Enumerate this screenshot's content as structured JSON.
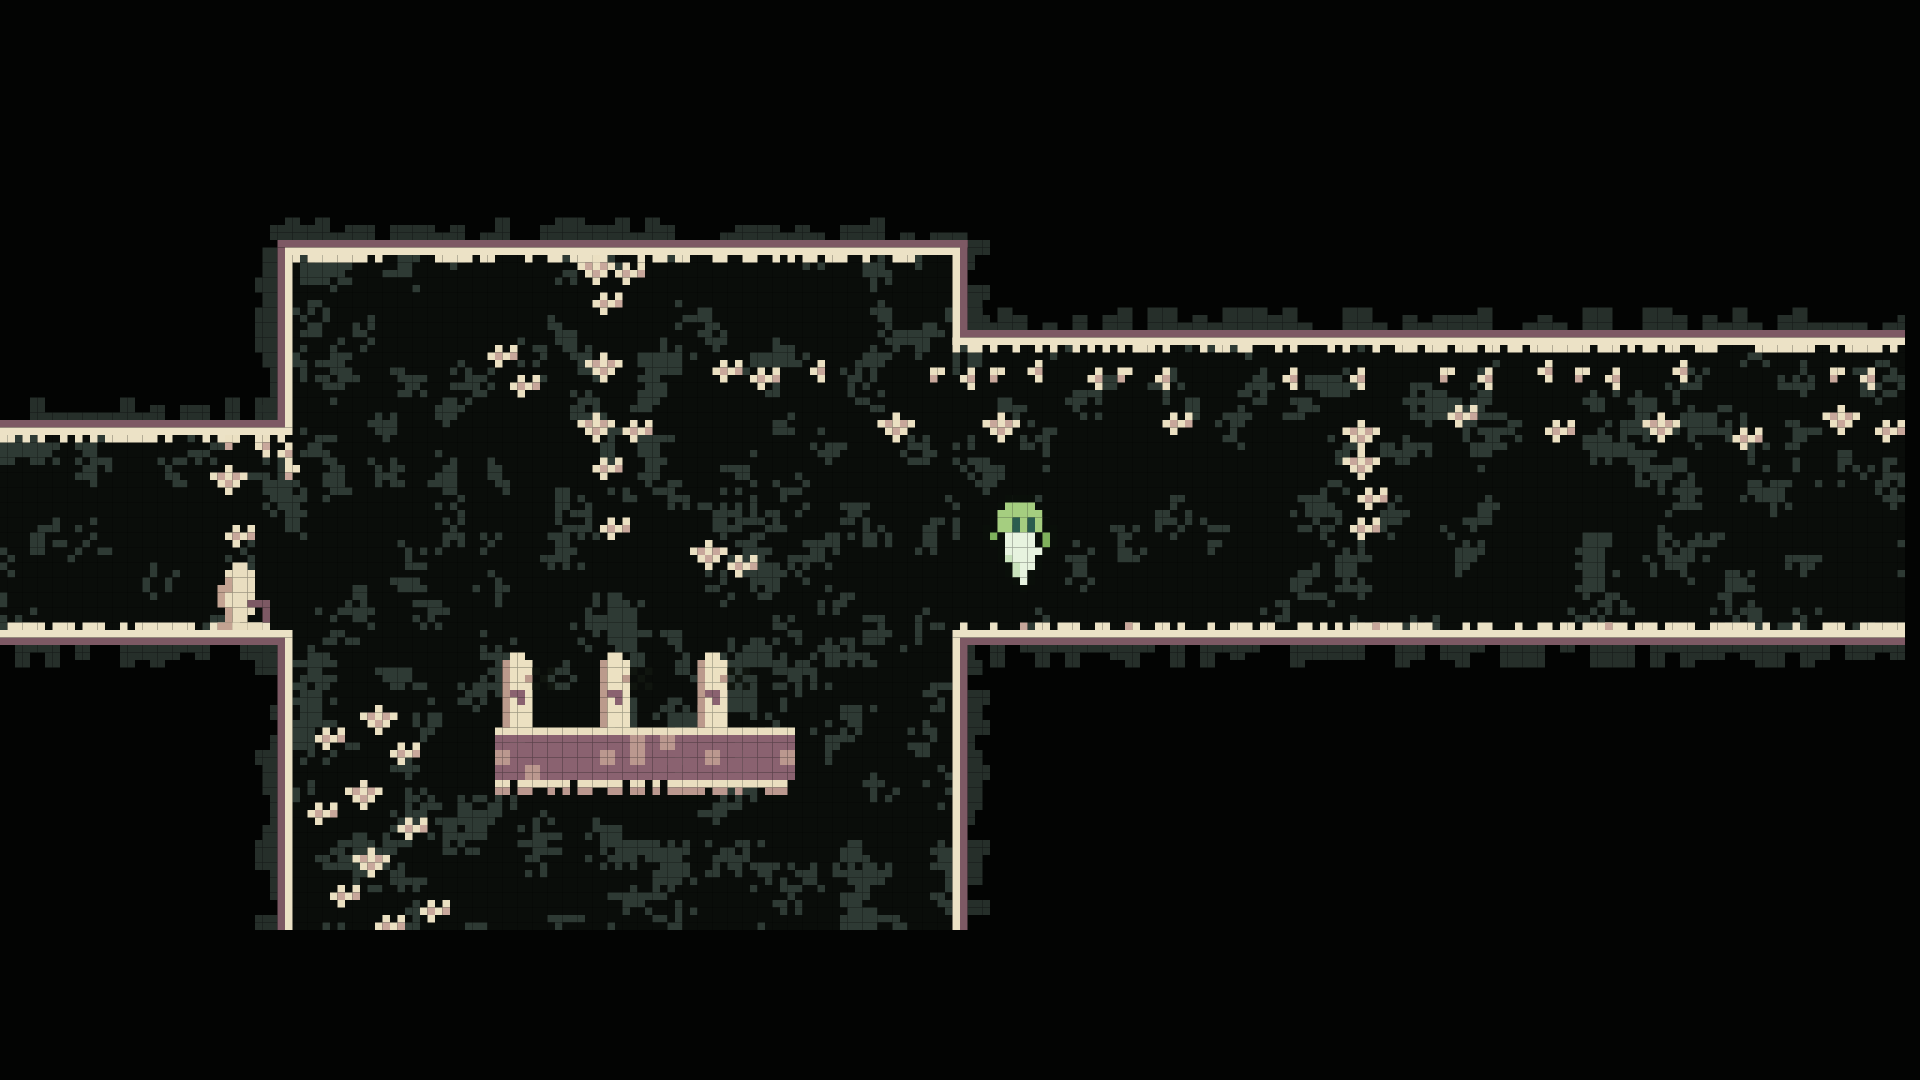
{
  "meta": {
    "scene": "pixel-art cave platformer room with floating ghost player"
  },
  "viewport": {
    "width": 1920,
    "height": 1080,
    "pixel_size": 7.5,
    "grid_w": 256,
    "grid_h": 144,
    "background": "#000000"
  },
  "palette": {
    "void": "#030403",
    "camo_green": "#5c7157",
    "camo_slate": "#2e3a34",
    "camo_black": "#0a0d0a",
    "fringe_green": "#44524a",
    "fringe_slate": "#262f2a",
    "border_cream": "#ece2c6",
    "border_mauve": "#7d5964",
    "plant_cream": "#ebe0c2",
    "plant_tan": "#c8a79b",
    "platform_cream": "#eadfc0",
    "platform_mauve": "#8a6270",
    "platform_tan": "#bb988f",
    "pillar_cream": "#ece1c2",
    "pillar_tan": "#bb9a8c",
    "pillar_mauve": "#8a6270",
    "decal_dark": "#10150f",
    "statue_cream": "#e9dec0",
    "statue_tan": "#c3a392",
    "statue_mauve": "#7d5964",
    "player_light": "#a5ce80",
    "player_green": "#7fb15c",
    "player_eye": "#2b5d4f",
    "player_body": "#e7f3df",
    "player_shade": "#c9e2bc",
    "player_outline": "#0a0f0a"
  },
  "regions": [
    {
      "name": "main-room",
      "x": 39,
      "y": 34,
      "w": 88,
      "h": 90
    },
    {
      "name": "left-corridor",
      "x": 0,
      "y": 58,
      "w": 39,
      "h": 26
    },
    {
      "name": "right-corridor",
      "x": 127,
      "y": 46,
      "w": 127,
      "h": 38
    }
  ],
  "borders": {
    "mauve": [
      {
        "x": 37,
        "y": 32,
        "w": 92,
        "h": 1
      },
      {
        "x": 37,
        "y": 33,
        "w": 1,
        "h": 23
      },
      {
        "x": 0,
        "y": 56,
        "w": 38,
        "h": 1
      },
      {
        "x": 0,
        "y": 85,
        "w": 38,
        "h": 1
      },
      {
        "x": 37,
        "y": 86,
        "w": 1,
        "h": 38
      },
      {
        "x": 128,
        "y": 32,
        "w": 1,
        "h": 12
      },
      {
        "x": 128,
        "y": 44,
        "w": 126,
        "h": 1
      },
      {
        "x": 128,
        "y": 85,
        "w": 126,
        "h": 1
      },
      {
        "x": 128,
        "y": 86,
        "w": 1,
        "h": 38
      }
    ],
    "cream": [
      {
        "x": 38,
        "y": 33,
        "w": 90,
        "h": 1,
        "nub": "down"
      },
      {
        "x": 38,
        "y": 34,
        "w": 1,
        "h": 23
      },
      {
        "x": 0,
        "y": 57,
        "w": 39,
        "h": 1,
        "nub": "down"
      },
      {
        "x": 0,
        "y": 84,
        "w": 39,
        "h": 1,
        "nub": "up"
      },
      {
        "x": 38,
        "y": 85,
        "w": 1,
        "h": 39
      },
      {
        "x": 127,
        "y": 34,
        "w": 1,
        "h": 12
      },
      {
        "x": 127,
        "y": 45,
        "w": 127,
        "h": 1,
        "nub": "down"
      },
      {
        "x": 127,
        "y": 84,
        "w": 127,
        "h": 1,
        "nub": "up"
      },
      {
        "x": 127,
        "y": 85,
        "w": 1,
        "h": 39
      }
    ]
  },
  "fringes": [
    {
      "x": 36,
      "y": 32,
      "len": 93,
      "side": "up"
    },
    {
      "x": 129,
      "y": 44,
      "len": 125,
      "side": "up"
    },
    {
      "x": 0,
      "y": 56,
      "len": 37,
      "side": "up"
    },
    {
      "x": 37,
      "y": 33,
      "len": 23,
      "side": "left"
    },
    {
      "x": 37,
      "y": 86,
      "len": 38,
      "side": "left"
    },
    {
      "x": 0,
      "y": 85,
      "len": 38,
      "side": "down"
    },
    {
      "x": 128,
      "y": 85,
      "len": 126,
      "side": "down"
    },
    {
      "x": 128,
      "y": 86,
      "len": 38,
      "side": "right"
    },
    {
      "x": 128,
      "y": 32,
      "len": 12,
      "side": "right"
    }
  ],
  "platform": {
    "x": 66,
    "y": 97,
    "w": 40,
    "h": 7,
    "drip_row": 104
  },
  "pillars": {
    "positions": [
      {
        "x": 67,
        "y": 87
      },
      {
        "x": 80,
        "y": 87
      },
      {
        "x": 93,
        "y": 87
      }
    ],
    "map": [
      ".CC.",
      "TCCC",
      "TCCC",
      "TCCT",
      "TCCC",
      "TMMC",
      "TCMC",
      "TCCC",
      "TCCC",
      "TCCC"
    ],
    "legend": {
      "C": "pillar_cream",
      "T": "pillar_tan",
      "M": "pillar_mauve"
    }
  },
  "decals": {
    "positions": [
      {
        "x": 71,
        "y": 89
      },
      {
        "x": 84,
        "y": 89
      },
      {
        "x": 97,
        "y": 89
      }
    ],
    "map": [
      "K.K",
      ".K.",
      "K.K"
    ],
    "legend": {
      "K": "decal_dark"
    }
  },
  "plants": {
    "legend": {
      "C": "plant_cream",
      "T": "plant_tan"
    },
    "maps": {
      "h1": [
        "CC",
        "T."
      ],
      "h2": [
        ".C",
        "CT",
        ".C"
      ],
      "c1": [
        ".C.C",
        "CTCT",
        ".C.."
      ],
      "c2": [
        "..C..",
        "CTCTC",
        ".CTC.",
        "..C.."
      ]
    },
    "frieze": {
      "y": 48,
      "x_start": 115,
      "x_end": 252,
      "step": 4.3,
      "variants": [
        "h1",
        "h2"
      ]
    },
    "items": [
      {
        "x": 77,
        "y": 34,
        "v": "c2"
      },
      {
        "x": 82,
        "y": 35,
        "v": "c1"
      },
      {
        "x": 79,
        "y": 39,
        "v": "c1"
      },
      {
        "x": 78,
        "y": 47,
        "v": "c2"
      },
      {
        "x": 77,
        "y": 55,
        "v": "c2"
      },
      {
        "x": 83,
        "y": 56,
        "v": "c1"
      },
      {
        "x": 79,
        "y": 61,
        "v": "c1"
      },
      {
        "x": 80,
        "y": 69,
        "v": "c1"
      },
      {
        "x": 92,
        "y": 72,
        "v": "c2"
      },
      {
        "x": 97,
        "y": 74,
        "v": "c1"
      },
      {
        "x": 65,
        "y": 46,
        "v": "c1"
      },
      {
        "x": 68,
        "y": 50,
        "v": "c1"
      },
      {
        "x": 95,
        "y": 48,
        "v": "c1"
      },
      {
        "x": 100,
        "y": 49,
        "v": "c1"
      },
      {
        "x": 108,
        "y": 48,
        "v": "h2"
      },
      {
        "x": 48,
        "y": 94,
        "v": "c2"
      },
      {
        "x": 42,
        "y": 97,
        "v": "c1"
      },
      {
        "x": 52,
        "y": 99,
        "v": "c1"
      },
      {
        "x": 46,
        "y": 104,
        "v": "c2"
      },
      {
        "x": 41,
        "y": 107,
        "v": "c1"
      },
      {
        "x": 53,
        "y": 109,
        "v": "c1"
      },
      {
        "x": 47,
        "y": 113,
        "v": "c2"
      },
      {
        "x": 44,
        "y": 118,
        "v": "c1"
      },
      {
        "x": 56,
        "y": 120,
        "v": "c1"
      },
      {
        "x": 50,
        "y": 122,
        "v": "c1"
      },
      {
        "x": 30,
        "y": 58,
        "v": "h1"
      },
      {
        "x": 34,
        "y": 58,
        "v": "h2"
      },
      {
        "x": 37,
        "y": 59,
        "v": "h2"
      },
      {
        "x": 38,
        "y": 62,
        "v": "h1"
      },
      {
        "x": 28,
        "y": 62,
        "v": "c2"
      },
      {
        "x": 30,
        "y": 70,
        "v": "c1"
      },
      {
        "x": 117,
        "y": 55,
        "v": "c2"
      },
      {
        "x": 131,
        "y": 55,
        "v": "c2"
      },
      {
        "x": 155,
        "y": 55,
        "v": "c1"
      },
      {
        "x": 179,
        "y": 56,
        "v": "c2"
      },
      {
        "x": 193,
        "y": 54,
        "v": "c1"
      },
      {
        "x": 206,
        "y": 56,
        "v": "c1"
      },
      {
        "x": 219,
        "y": 55,
        "v": "c2"
      },
      {
        "x": 231,
        "y": 57,
        "v": "c1"
      },
      {
        "x": 243,
        "y": 54,
        "v": "c2"
      },
      {
        "x": 250,
        "y": 56,
        "v": "c1"
      },
      {
        "x": 179,
        "y": 60,
        "v": "c2"
      },
      {
        "x": 181,
        "y": 65,
        "v": "c1"
      },
      {
        "x": 180,
        "y": 69,
        "v": "c1"
      }
    ]
  },
  "floor_specks": [
    {
      "x": 136,
      "y": 83
    },
    {
      "x": 150,
      "y": 83
    },
    {
      "x": 183,
      "y": 83
    },
    {
      "x": 214,
      "y": 83
    }
  ],
  "sprites": {
    "statue": {
      "x": 29,
      "y": 75,
      "legend": {
        "C": "statue_cream",
        "T": "statue_tan",
        "M": "statue_mauve"
      },
      "map": [
        "..CC....",
        ".CCCC...",
        ".TCCC...",
        "TTCCC...",
        "TCCCC...",
        "TCCCMMM.",
        ".TCCC.M.",
        ".TCC..M.",
        "TTCCCC.."
      ]
    },
    "player": {
      "x": 131,
      "y": 66,
      "legend": {
        "K": "player_outline",
        "L": "player_light",
        "G": "player_green",
        "D": "player_eye",
        "W": "player_body",
        "w": "player_shade"
      },
      "map": [
        "...KKKK...",
        "..KLLLLK..",
        ".KLLLLLLK.",
        ".KLLDLDLK.",
        "KKLLDLDLKK",
        "KGKWWWWKGK",
        ".KKWWWWKGK",
        "..KWWWWWK.",
        "..KwWWWK..",
        "...KwWWK..",
        "...KwWK...",
        "....KWK...",
        ".....K...."
      ]
    }
  },
  "annotations": {
    "game_viewport": {
      "x": 0,
      "y": 0,
      "w": 256,
      "h": 144
    },
    "main_room": {
      "x": 39,
      "y": 34,
      "w": 88,
      "h": 90
    },
    "left_corridor": {
      "x": 0,
      "y": 58,
      "w": 39,
      "h": 26
    },
    "right_corridor": {
      "x": 127,
      "y": 46,
      "w": 127,
      "h": 38
    },
    "pillar_platform": {
      "x": 66,
      "y": 87,
      "w": 40,
      "h": 19
    },
    "statue": {
      "x": 29,
      "y": 75,
      "w": 8,
      "h": 9
    },
    "player": {
      "x": 131,
      "y": 66,
      "w": 10,
      "h": 13
    }
  }
}
